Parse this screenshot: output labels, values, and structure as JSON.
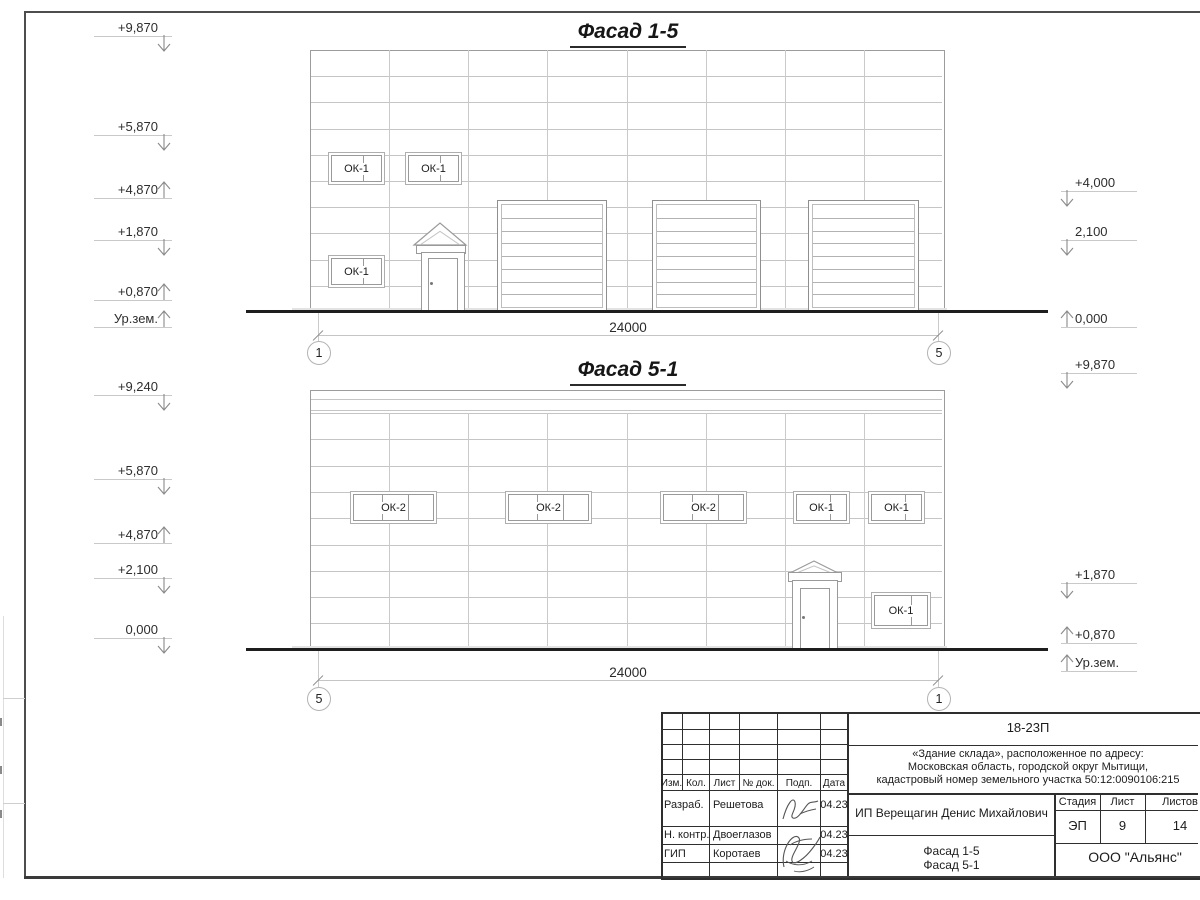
{
  "sheet": {
    "facades": [
      {
        "title": "Фасад 1-5",
        "dimension": "24000",
        "axis_left": "1",
        "axis_right": "5",
        "window_labels": [
          "ОК-1",
          "ОК-1",
          "ОК-1"
        ],
        "marks_left": [
          "+9,870",
          "+5,870",
          "+4,870",
          "+1,870",
          "+0,870",
          "Ур.зем."
        ],
        "marks_right": [
          "+4,000",
          "2,100",
          "0,000",
          "+9,870"
        ]
      },
      {
        "title": "Фасад 5-1",
        "dimension": "24000",
        "axis_left": "5",
        "axis_right": "1",
        "window_labels": [
          "ОК-2",
          "ОК-2",
          "ОК-2",
          "ОК-1",
          "ОК-1",
          "ОК-1"
        ],
        "marks_left": [
          "+9,240",
          "+5,870",
          "+4,870",
          "+2,100",
          "0,000"
        ],
        "marks_right": [
          "+1,870",
          "+0,870",
          "Ур.зем."
        ]
      }
    ],
    "title_block": {
      "project_code": "18-23П",
      "address_lines": [
        "«Здание склада», расположенное по адресу:",
        "Московская область, городской округ Мытищи,",
        "кадастровый номер земельного участка 50:12:0090106:215"
      ],
      "client": "ИП Верещагин Денис Михайлович",
      "sheet_title_lines": [
        "Фасад 1-5",
        "Фасад 5-1"
      ],
      "company": "ООО \"Альянс\"",
      "header_cols": [
        "Изм.",
        "Кол.",
        "Лист",
        "№ док.",
        "Подп.",
        "Дата"
      ],
      "stage_cols": [
        "Стадия",
        "Лист",
        "Листов"
      ],
      "stage_values": [
        "ЭП",
        "9",
        "14"
      ],
      "signers": [
        {
          "role": "Разраб.",
          "name": "Решетова",
          "date": "04.23"
        },
        {
          "role": "Н. контр.",
          "name": "Двоеглазов",
          "date": "04.23"
        },
        {
          "role": "ГИП",
          "name": "Коротаев",
          "date": "04.23"
        }
      ]
    }
  }
}
